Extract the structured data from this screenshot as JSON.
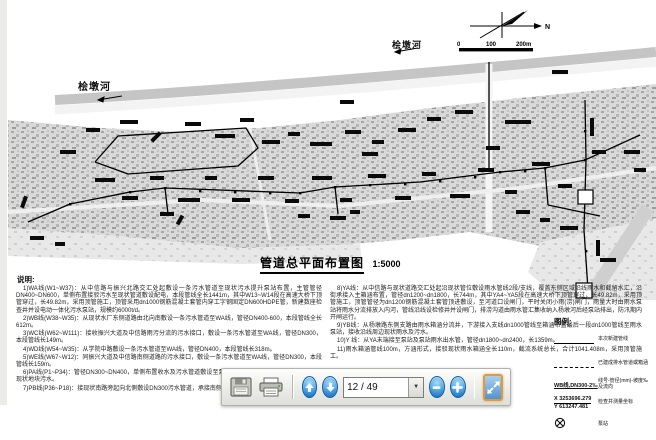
{
  "map": {
    "river_label": "桧墩河",
    "north_label": "N",
    "scalebar": {
      "zero": "0",
      "mid": "100",
      "end": "200m"
    }
  },
  "title": {
    "text": "管道总平面布置图",
    "scale": "1:5000"
  },
  "notes": {
    "heading": "说明:",
    "left": [
      "1)WA线(W1~W37)：从中信路与振兴北路交汇处起敷设一条污水管道至现状污水提升泵站布置，主管管径DN400~DN600，单侧布置接驳污水至现状管道敷设配电，本段管线全长1441m，其中W13~W14段在高速大桥下顶管穿过，长49.82m，采用顶管施工，顶管采用dn1000钢筋混凝土套管内穿工字钢固定DN600HDPE管，新建数座检查井并设电动一体化污水泵站，规模约6000t/d。",
      "2)WB线(W38~W35)：从现状水厂东侧道路由北向南敷设一条污水管道至WA线，管径DN400-600，本段管线全长612m。",
      "3)WC线(W62~W111)：接收振兴大道及中信路雨污分流的污水接口，敷设一条污水管道至WA线，管径DN300，本段管线长149m。",
      "4)WD线(W54~W35)：从学院中路敷设一条污水管道至WA线，管径DN400，本段管线长318m。",
      "5)WE线(W67~W12)：同振兴大道及中信路南侧道路的污水接口，敷设一条污水管道至WA线，管径DN300，本段管线长159m。",
      "6)PA线(P1~P34)：管径DN300~DN400，单侧布置收水及污水管道敷设至泵站，本段管线全长1182m，沿线承接现状地块污水。",
      "7)PB线(P36~P18)：接现状南路旁起向北侧敷设DN300污水管道，承接南侧地块污水至PA线，采用开槽施工。"
    ],
    "right": [
      "8)YA线：从中信路与现状道路交汇处起沿现状管位敷设雨水管线2段/支线，覆盖东侧区域沿线雨水和截留水汇，沿街承接入主箱涵布置，管径dn1200~dn1800，长744m，其中YA4~YA5段在高速大桥下顶管穿过，长49.82m，采用顶管施工，顶管管径为dn1200钢筋混凝土套管顶进敷设，至河道口设闸门，平时关闭小雨(涝)闸门，雨量大时由雨水泵站将雨水分流排放入内河，管线沿线设检修井并设闸门，排涝沟道由雨水管汇集收纳入杨墩河后经泵站排出，防汛期内开闸运行。",
      "9)YB线：从杨墩路东侧支路由雨水箱涵分流井，下游接入支线dn1000管线至箱涵布置最后一段dn1000管线至雨水泵站，接收沿线周边现状雨水及污水。",
      "10)Y 线：从YA末端接至泵站及泵站雨水出水管，管径dn1800~dn2400，长1359m。",
      "11)雨水箱涵管线100m，方涵形式，接驳现状雨水箱涵全长110m，截流系统总长，合计1041.408m，采用顶管施工。"
    ]
  },
  "legend": {
    "heading": "图例:",
    "wb_symbol": "WB线,DN300-2‰",
    "coord_x": "X 3253696.279",
    "coord_y": "Y 613247.481",
    "rows": [
      "本次新建管线",
      "已建成排水管道或箱涵",
      "线号-管径(mm)-坡度‰ 及流向",
      "检查井测量坐标",
      "泵站"
    ]
  },
  "toolbar": {
    "page_value": "12 / 49"
  }
}
